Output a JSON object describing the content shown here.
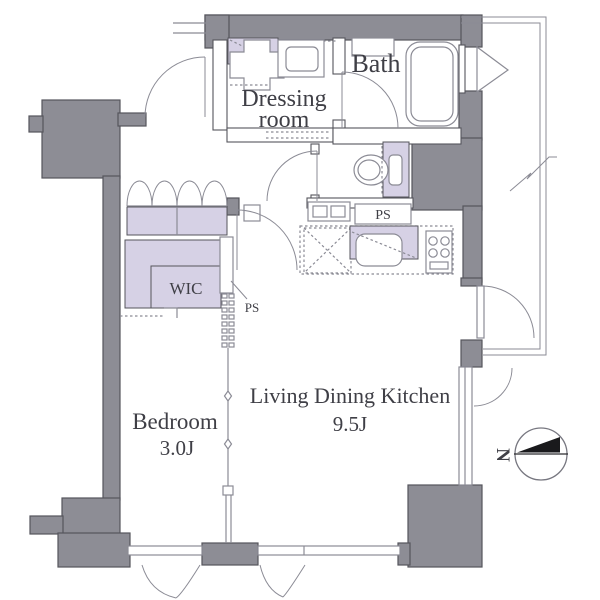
{
  "plan": {
    "rooms": {
      "dressing_room": {
        "label_line1": "Dressing",
        "label_line2": "room"
      },
      "bath": {
        "label": "Bath"
      },
      "wic": {
        "label": "WIC"
      },
      "bedroom": {
        "label": "Bedroom",
        "size": "3.0J"
      },
      "ldk": {
        "label": "Living Dining Kitchen",
        "size": "9.5J"
      }
    },
    "pipe_spaces": {
      "kitchen_ps": "PS",
      "wall_ps": "PS"
    },
    "compass": {
      "north": "N"
    },
    "colors": {
      "wall": "#8d8d95",
      "wall_outline": "#55555c",
      "fixture_accent": "#d6d1e5",
      "line": "#8b8b95",
      "text": "#3f3f46",
      "background": "#ffffff"
    }
  }
}
